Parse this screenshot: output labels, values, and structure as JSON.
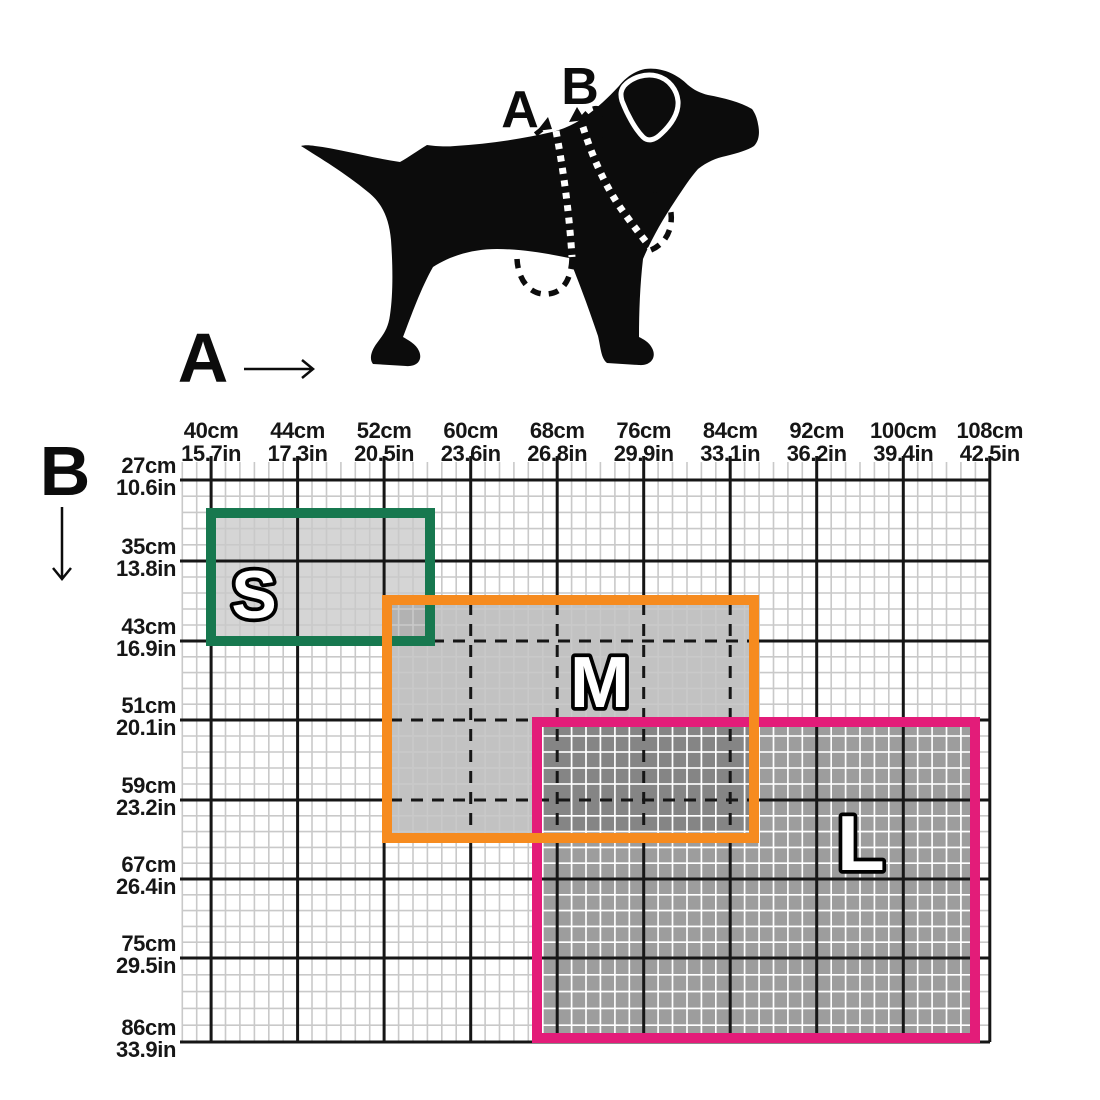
{
  "measurements": {
    "a_label": "A",
    "b_label": "B"
  },
  "chart_data": {
    "type": "area",
    "description": "Dog harness size chart: rectangular size regions S, M, L plotted on a grid. Top axis = measurement A (girth, cm/in), left axis = measurement B (cm/in), per dog pictogram with dashed measuring loops.",
    "grid": true,
    "legend_position": "none",
    "x_axis": {
      "label": "A",
      "ticks": [
        {
          "cm": "40cm",
          "in": "15.7in"
        },
        {
          "cm": "44cm",
          "in": "17.3in"
        },
        {
          "cm": "52cm",
          "in": "20.5in"
        },
        {
          "cm": "60cm",
          "in": "23.6in"
        },
        {
          "cm": "68cm",
          "in": "26.8in"
        },
        {
          "cm": "76cm",
          "in": "29.9in"
        },
        {
          "cm": "84cm",
          "in": "33.1in"
        },
        {
          "cm": "92cm",
          "in": "36.2in"
        },
        {
          "cm": "100cm",
          "in": "39.4in"
        },
        {
          "cm": "108cm",
          "in": "42.5in"
        }
      ],
      "range_cm": [
        40,
        108
      ]
    },
    "y_axis": {
      "label": "B",
      "ticks": [
        {
          "cm": "27cm",
          "in": "10.6in"
        },
        {
          "cm": "35cm",
          "in": "13.8in"
        },
        {
          "cm": "43cm",
          "in": "16.9in"
        },
        {
          "cm": "51cm",
          "in": "20.1in"
        },
        {
          "cm": "59cm",
          "in": "23.2in"
        },
        {
          "cm": "67cm",
          "in": "26.4in"
        },
        {
          "cm": "75cm",
          "in": "29.5in"
        },
        {
          "cm": "86cm",
          "in": "33.9in"
        }
      ],
      "range_cm": [
        27,
        86
      ]
    },
    "sizes": [
      {
        "label": "S",
        "border_color": "#17784f",
        "a_range_cm_approx": [
          40,
          56
        ],
        "b_range_cm_approx": [
          30,
          43
        ],
        "px_rect": [
          211,
          513,
          430,
          641
        ]
      },
      {
        "label": "M",
        "border_color": "#f68b1f",
        "a_range_cm_approx": [
          52,
          86
        ],
        "b_range_cm_approx": [
          39,
          63
        ],
        "px_rect": [
          387,
          600,
          754,
          838
        ]
      },
      {
        "label": "L",
        "border_color": "#e31c79",
        "a_range_cm_approx": [
          66,
          107
        ],
        "b_range_cm_approx": [
          51,
          86
        ],
        "px_rect": [
          537,
          722,
          975,
          1038
        ]
      }
    ]
  }
}
